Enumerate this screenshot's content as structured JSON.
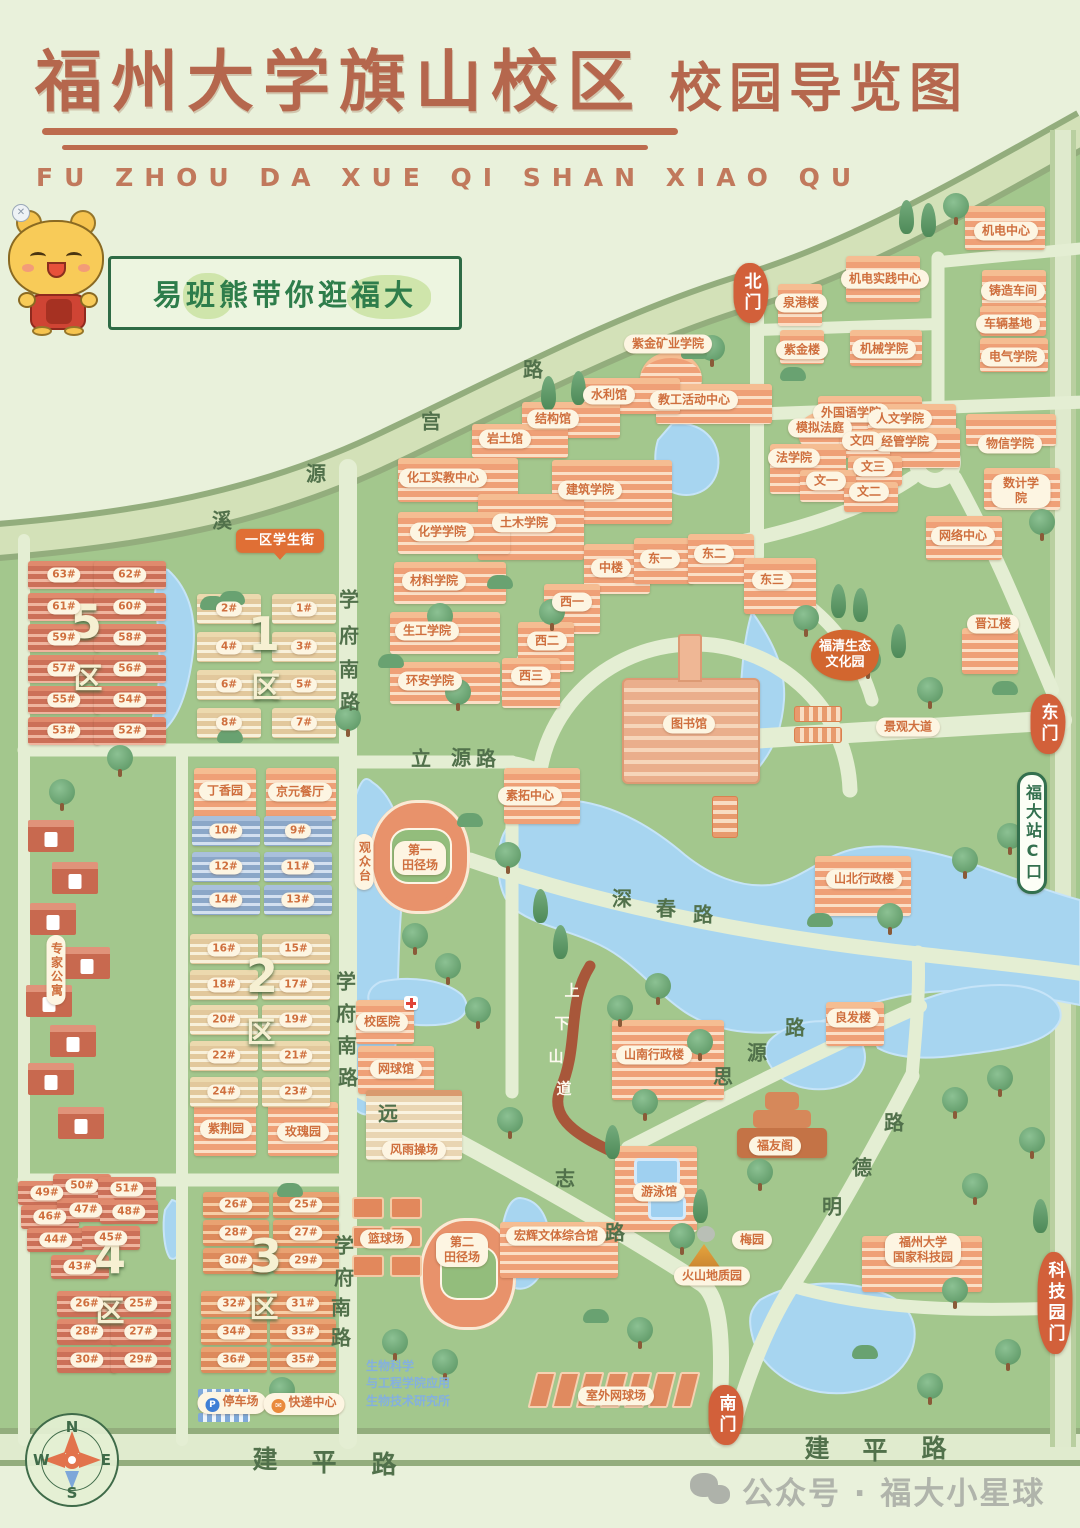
{
  "title": {
    "main": "福州大学旗山校区",
    "tail": "校园导览图",
    "latin": "FU ZHOU DA XUE QI SHAN XIAO QU"
  },
  "banner": {
    "text": "易班熊带你逛福大"
  },
  "watermark": {
    "icon": "wechat-icon",
    "text": "公众号 · 福大小星球"
  },
  "compass": {
    "n": "N",
    "e": "E",
    "s": "S",
    "w": "W"
  },
  "colors": {
    "accent": "#b5674d",
    "label_text": "#cf6f3e",
    "gate": "#d2603a",
    "water": "#a7d5f0",
    "land": "#a3c78d",
    "road": "#e4eed3",
    "banner_green": "#2e7d4b"
  },
  "map": {
    "gates": [
      {
        "n": "gate-north",
        "t": "北门",
        "x": 751,
        "y": 293
      },
      {
        "n": "gate-east",
        "t": "东门",
        "x": 1048,
        "y": 724
      },
      {
        "n": "gate-south",
        "t": "南门",
        "x": 726,
        "y": 1415
      },
      {
        "n": "gate-techpark",
        "t": "科技园门",
        "x": 1055,
        "y": 1303
      }
    ],
    "pois": [
      {
        "t": "机电中心",
        "x": 1006,
        "y": 231,
        "b": [
          965,
          206,
          80,
          44
        ]
      },
      {
        "t": "机电实践中心",
        "x": 885,
        "y": 279,
        "b": [
          846,
          256,
          74,
          46
        ]
      },
      {
        "t": "泉港楼",
        "x": 801,
        "y": 303,
        "b": [
          778,
          284,
          44,
          42
        ]
      },
      {
        "t": "铸造车间",
        "x": 1013,
        "y": 291,
        "b": [
          982,
          270,
          64,
          38
        ]
      },
      {
        "t": "车辆基地",
        "x": 1008,
        "y": 324,
        "b": [
          980,
          306,
          66,
          30
        ]
      },
      {
        "t": "紫金楼",
        "x": 802,
        "y": 350,
        "b": [
          780,
          330,
          44,
          34
        ]
      },
      {
        "t": "机械学院",
        "x": 884,
        "y": 349,
        "b": [
          850,
          330,
          72,
          36
        ]
      },
      {
        "t": "电气学院",
        "x": 1013,
        "y": 357,
        "b": [
          980,
          338,
          68,
          34
        ]
      },
      {
        "t": "物信学院",
        "x": 1010,
        "y": 444,
        "b": [
          966,
          414,
          90,
          32
        ]
      },
      {
        "t": "数计学院",
        "x": 1021,
        "y": 491,
        "b": [
          984,
          468,
          76,
          42
        ]
      },
      {
        "t": "网络中心",
        "x": 963,
        "y": 536,
        "b": [
          926,
          516,
          76,
          44
        ]
      },
      {
        "t": "外国语学院",
        "x": 851,
        "y": 413,
        "b": [
          818,
          396,
          104,
          34
        ]
      },
      {
        "t": "人文学院",
        "x": 900,
        "y": 419,
        "b": [
          868,
          404,
          88,
          42
        ]
      },
      {
        "t": "模拟法庭",
        "x": 820,
        "y": 428,
        "b": [
          798,
          412,
          48,
          42,
          "b-or b-round"
        ]
      },
      {
        "t": "经管学院",
        "x": 905,
        "y": 442,
        "b": [
          872,
          428,
          88,
          40
        ]
      },
      {
        "t": "文四",
        "x": 862,
        "y": 441,
        "b": [
          840,
          430,
          50,
          28
        ]
      },
      {
        "t": "法学院",
        "x": 794,
        "y": 458,
        "b": [
          770,
          444,
          76,
          50
        ]
      },
      {
        "t": "文三",
        "x": 873,
        "y": 467,
        "b": [
          848,
          456,
          54,
          30
        ]
      },
      {
        "t": "文一",
        "x": 826,
        "y": 481,
        "b": [
          800,
          470,
          56,
          32
        ]
      },
      {
        "t": "文二",
        "x": 869,
        "y": 492,
        "b": [
          844,
          482,
          54,
          30
        ]
      },
      {
        "t": "紫金矿业学院",
        "x": 668,
        "y": 344,
        "b": [
          640,
          352,
          62,
          54,
          "b-or b-round"
        ]
      },
      {
        "t": "教工活动中心",
        "x": 694,
        "y": 400,
        "b": [
          656,
          384,
          116,
          40
        ]
      },
      {
        "t": "水利馆",
        "x": 609,
        "y": 395,
        "b": [
          578,
          378,
          102,
          36
        ]
      },
      {
        "t": "结构馆",
        "x": 553,
        "y": 419,
        "b": [
          522,
          402,
          98,
          36
        ]
      },
      {
        "t": "岩土馆",
        "x": 505,
        "y": 439,
        "b": [
          472,
          424,
          96,
          34
        ]
      },
      {
        "t": "化工实教中心",
        "x": 443,
        "y": 478,
        "b": [
          398,
          458,
          120,
          44
        ]
      },
      {
        "t": "建筑学院",
        "x": 590,
        "y": 490,
        "b": [
          552,
          460,
          120,
          64
        ]
      },
      {
        "t": "土木学院",
        "x": 524,
        "y": 523,
        "b": [
          478,
          494,
          106,
          66
        ]
      },
      {
        "t": "化学学院",
        "x": 442,
        "y": 532,
        "b": [
          398,
          512,
          112,
          42
        ]
      },
      {
        "t": "材料学院",
        "x": 434,
        "y": 581,
        "b": [
          394,
          562,
          112,
          42
        ]
      },
      {
        "t": "生工学院",
        "x": 427,
        "y": 631,
        "b": [
          390,
          612,
          110,
          42
        ]
      },
      {
        "t": "环安学院",
        "x": 430,
        "y": 681,
        "b": [
          390,
          662,
          110,
          42
        ]
      },
      {
        "t": "中楼",
        "x": 611,
        "y": 568,
        "b": [
          584,
          544,
          66,
          50
        ]
      },
      {
        "t": "东一",
        "x": 660,
        "y": 559,
        "b": [
          634,
          538,
          60,
          46
        ]
      },
      {
        "t": "东二",
        "x": 714,
        "y": 554,
        "b": [
          688,
          534,
          66,
          50
        ]
      },
      {
        "t": "东三",
        "x": 772,
        "y": 580,
        "b": [
          744,
          558,
          72,
          56
        ]
      },
      {
        "t": "西一",
        "x": 572,
        "y": 602,
        "b": [
          544,
          584,
          56,
          50
        ]
      },
      {
        "t": "西二",
        "x": 547,
        "y": 641,
        "b": [
          518,
          622,
          56,
          50
        ]
      },
      {
        "t": "西三",
        "x": 531,
        "y": 676,
        "b": [
          502,
          658,
          58,
          50
        ]
      },
      {
        "n": "library-label",
        "t": "图书馆",
        "x": 689,
        "y": 724,
        "b": [
          622,
          678,
          138,
          106,
          "lib"
        ]
      },
      {
        "t": "素拓中心",
        "x": 530,
        "y": 796,
        "b": [
          504,
          768,
          76,
          56
        ]
      },
      {
        "t": "晋江楼",
        "x": 993,
        "y": 624,
        "b": [
          962,
          628,
          56,
          46
        ]
      },
      {
        "t": "山北行政楼",
        "x": 864,
        "y": 879,
        "b": [
          815,
          856,
          96,
          60
        ]
      },
      {
        "t": "山南行政楼",
        "x": 654,
        "y": 1055,
        "b": [
          612,
          1020,
          112,
          80
        ]
      },
      {
        "t": "良发楼",
        "x": 853,
        "y": 1018,
        "b": [
          826,
          1002,
          58,
          44
        ]
      },
      {
        "t": "福友阁",
        "x": 775,
        "y": 1146
      },
      {
        "t": "福州大学\n国家科技园",
        "x": 923,
        "y": 1250,
        "b": [
          862,
          1236,
          120,
          56
        ]
      },
      {
        "t": "游泳馆",
        "x": 659,
        "y": 1192,
        "b": [
          615,
          1146,
          82,
          86
        ]
      },
      {
        "t": "梅园",
        "x": 752,
        "y": 1240
      },
      {
        "t": "火山地质园",
        "x": 712,
        "y": 1276
      },
      {
        "t": "宏辉文体综合馆",
        "x": 556,
        "y": 1236,
        "b": [
          500,
          1222,
          118,
          56
        ]
      },
      {
        "t": "校医院",
        "x": 382,
        "y": 1022,
        "b": [
          356,
          1000,
          58,
          44
        ]
      },
      {
        "t": "网球馆",
        "x": 396,
        "y": 1069,
        "b": [
          358,
          1046,
          76,
          48
        ]
      },
      {
        "t": "风雨操场",
        "x": 414,
        "y": 1150,
        "b": [
          366,
          1090,
          96,
          70,
          "b-cream"
        ]
      },
      {
        "t": "第一\n田径场",
        "x": 420,
        "y": 858
      },
      {
        "t": "观众台",
        "x": 364,
        "y": 862,
        "vert": 1
      },
      {
        "t": "第二\n田径场",
        "x": 462,
        "y": 1250
      },
      {
        "t": "篮球场",
        "x": 386,
        "y": 1239
      },
      {
        "t": "室外网球场",
        "x": 616,
        "y": 1396
      },
      {
        "t": "停车场",
        "x": 232,
        "y": 1403,
        "icon": "P"
      },
      {
        "t": "快递中心",
        "x": 304,
        "y": 1404,
        "icon": "✉"
      },
      {
        "t": "丁香园",
        "x": 225,
        "y": 791,
        "b": [
          194,
          768,
          62,
          52
        ]
      },
      {
        "t": "京元餐厅",
        "x": 300,
        "y": 792,
        "b": [
          266,
          768,
          70,
          52
        ]
      },
      {
        "t": "紫荆园",
        "x": 226,
        "y": 1129,
        "b": [
          194,
          1102,
          62,
          54
        ]
      },
      {
        "t": "玫瑰园",
        "x": 303,
        "y": 1132,
        "b": [
          268,
          1102,
          70,
          54
        ]
      },
      {
        "t": "专家公寓",
        "x": 56,
        "y": 970,
        "vert": 1
      },
      {
        "n": "street-sign",
        "t": "一区学生街",
        "x": 280,
        "y": 541,
        "cls": "sign-orange"
      },
      {
        "t": "福清生态\n文化园",
        "x": 845,
        "y": 655,
        "cls": "blob-orange"
      },
      {
        "t": "景观大道",
        "x": 908,
        "y": 727
      },
      {
        "t": "生物科学\n与工程学院应用\n生物技术研究所",
        "x": 408,
        "y": 1384,
        "cls": "bio-text"
      },
      {
        "n": "metro-sign",
        "t": "福大站C口",
        "x": 1032,
        "y": 833,
        "vert": 1,
        "cls": "sign-green"
      }
    ],
    "dorm_groups": [
      {
        "cls": "b-brick",
        "w": 72,
        "h": 28,
        "cols": [
          28,
          94
        ],
        "rows": [
          561,
          593,
          624,
          655,
          686,
          717
        ],
        "nums": [
          [
            "63#",
            "62#"
          ],
          [
            "61#",
            "60#"
          ],
          [
            "59#",
            "58#"
          ],
          [
            "57#",
            "56#"
          ],
          [
            "55#",
            "54#"
          ],
          [
            "53#",
            "52#"
          ]
        ]
      },
      {
        "cls": "b-tan",
        "w": 64,
        "h": 30,
        "cols": [
          197,
          272
        ],
        "rows": [
          594,
          632,
          670,
          708
        ],
        "nums": [
          [
            "2#",
            "1#"
          ],
          [
            "4#",
            "3#"
          ],
          [
            "6#",
            "5#"
          ],
          [
            "8#",
            "7#"
          ]
        ]
      },
      {
        "cls": "b-blue",
        "w": 68,
        "h": 30,
        "cols": [
          192,
          264
        ],
        "rows": [
          816,
          852,
          885
        ],
        "nums": [
          [
            "10#",
            "9#"
          ],
          [
            "12#",
            "11#"
          ],
          [
            "14#",
            "13#"
          ]
        ]
      },
      {
        "cls": "b-tan",
        "w": 68,
        "h": 30,
        "cols": [
          190,
          262
        ],
        "rows": [
          934,
          970,
          1005,
          1041,
          1077
        ],
        "nums": [
          [
            "16#",
            "15#"
          ],
          [
            "18#",
            "17#"
          ],
          [
            "20#",
            "19#"
          ],
          [
            "22#",
            "21#"
          ],
          [
            "24#",
            "23#"
          ]
        ]
      },
      {
        "cls": "b-brick",
        "w": 60,
        "h": 26,
        "cols": [
          57,
          111
        ],
        "rows": [
          1291,
          1319,
          1347
        ],
        "nums": [
          [
            "26#",
            "25#"
          ],
          [
            "28#",
            "27#"
          ],
          [
            "30#",
            "29#"
          ]
        ]
      },
      {
        "cls": "b-or2",
        "w": 66,
        "h": 26,
        "cols": [
          203,
          273
        ],
        "rows": [
          1192,
          1220,
          1248
        ],
        "nums": [
          [
            "26#",
            "25#"
          ],
          [
            "28#",
            "27#"
          ],
          [
            "30#",
            "29#"
          ]
        ]
      },
      {
        "cls": "b-or2",
        "w": 66,
        "h": 26,
        "cols": [
          201,
          270
        ],
        "rows": [
          1291,
          1319,
          1347
        ],
        "nums": [
          [
            "32#",
            "31#"
          ],
          [
            "34#",
            "33#"
          ],
          [
            "36#",
            "35#"
          ]
        ]
      }
    ],
    "dorm_free": [
      {
        "t": "49#",
        "x": 47,
        "y": 1193
      },
      {
        "t": "50#",
        "x": 82,
        "y": 1186
      },
      {
        "t": "51#",
        "x": 127,
        "y": 1189
      },
      {
        "t": "46#",
        "x": 50,
        "y": 1217
      },
      {
        "t": "47#",
        "x": 86,
        "y": 1210
      },
      {
        "t": "48#",
        "x": 129,
        "y": 1212
      },
      {
        "t": "44#",
        "x": 56,
        "y": 1240
      },
      {
        "t": "45#",
        "x": 111,
        "y": 1238
      },
      {
        "t": "43#",
        "x": 80,
        "y": 1267
      }
    ],
    "districts": [
      {
        "t": "5",
        "x": 86,
        "y": 622,
        "big": 1
      },
      {
        "t": "区",
        "x": 88,
        "y": 676
      },
      {
        "t": "1",
        "x": 264,
        "y": 634,
        "big": 1
      },
      {
        "t": "区",
        "x": 266,
        "y": 685
      },
      {
        "t": "2",
        "x": 262,
        "y": 976,
        "big": 1
      },
      {
        "t": "区",
        "x": 261,
        "y": 1030
      },
      {
        "t": "4",
        "x": 110,
        "y": 1257,
        "big": 1
      },
      {
        "t": "区",
        "x": 110,
        "y": 1309
      },
      {
        "t": "3",
        "x": 266,
        "y": 1256,
        "big": 1
      },
      {
        "t": "区",
        "x": 264,
        "y": 1305
      }
    ],
    "road_chars": [
      {
        "t": "溪",
        "x": 222,
        "y": 519
      },
      {
        "t": "源",
        "x": 316,
        "y": 472
      },
      {
        "t": "宫",
        "x": 431,
        "y": 420
      },
      {
        "t": "路",
        "x": 533,
        "y": 368
      },
      {
        "t": "学",
        "x": 349,
        "y": 598
      },
      {
        "t": "府",
        "x": 349,
        "y": 634
      },
      {
        "t": "南",
        "x": 349,
        "y": 668
      },
      {
        "t": "路",
        "x": 350,
        "y": 700
      },
      {
        "t": "学",
        "x": 346,
        "y": 980
      },
      {
        "t": "府",
        "x": 346,
        "y": 1012
      },
      {
        "t": "南",
        "x": 347,
        "y": 1044
      },
      {
        "t": "路",
        "x": 348,
        "y": 1076
      },
      {
        "t": "学",
        "x": 344,
        "y": 1244
      },
      {
        "t": "府",
        "x": 344,
        "y": 1276
      },
      {
        "t": "南",
        "x": 341,
        "y": 1306
      },
      {
        "t": "路",
        "x": 341,
        "y": 1336
      },
      {
        "t": "立",
        "x": 421,
        "y": 757
      },
      {
        "t": "源",
        "x": 461,
        "y": 756
      },
      {
        "t": "路",
        "x": 486,
        "y": 757
      },
      {
        "t": "深",
        "x": 622,
        "y": 897
      },
      {
        "t": "春",
        "x": 666,
        "y": 907
      },
      {
        "t": "路",
        "x": 703,
        "y": 913
      },
      {
        "t": "思",
        "x": 723,
        "y": 1075
      },
      {
        "t": "源",
        "x": 757,
        "y": 1051
      },
      {
        "t": "路",
        "x": 795,
        "y": 1026
      },
      {
        "t": "远",
        "x": 388,
        "y": 1112
      },
      {
        "t": "志",
        "x": 565,
        "y": 1177
      },
      {
        "t": "路",
        "x": 615,
        "y": 1231
      },
      {
        "t": "路",
        "x": 894,
        "y": 1121
      },
      {
        "t": "德",
        "x": 862,
        "y": 1166
      },
      {
        "t": "明",
        "x": 832,
        "y": 1205
      },
      {
        "t": "建",
        "x": 265,
        "y": 1458,
        "cls": "rc-big"
      },
      {
        "t": "平",
        "x": 324,
        "y": 1461,
        "cls": "rc-big"
      },
      {
        "t": "路",
        "x": 384,
        "y": 1463,
        "cls": "rc-big"
      },
      {
        "t": "建",
        "x": 817,
        "y": 1447,
        "cls": "rc-big"
      },
      {
        "t": "平",
        "x": 875,
        "y": 1449,
        "cls": "rc-big"
      },
      {
        "t": "路",
        "x": 934,
        "y": 1447,
        "cls": "rc-big"
      },
      {
        "t": "上",
        "x": 572,
        "y": 990,
        "cls": "rc-white"
      },
      {
        "t": "下",
        "x": 562,
        "y": 1023,
        "cls": "rc-white"
      },
      {
        "t": "山",
        "x": 556,
        "y": 1056,
        "cls": "rc-white"
      },
      {
        "t": "道",
        "x": 564,
        "y": 1088,
        "cls": "rc-white"
      }
    ]
  }
}
